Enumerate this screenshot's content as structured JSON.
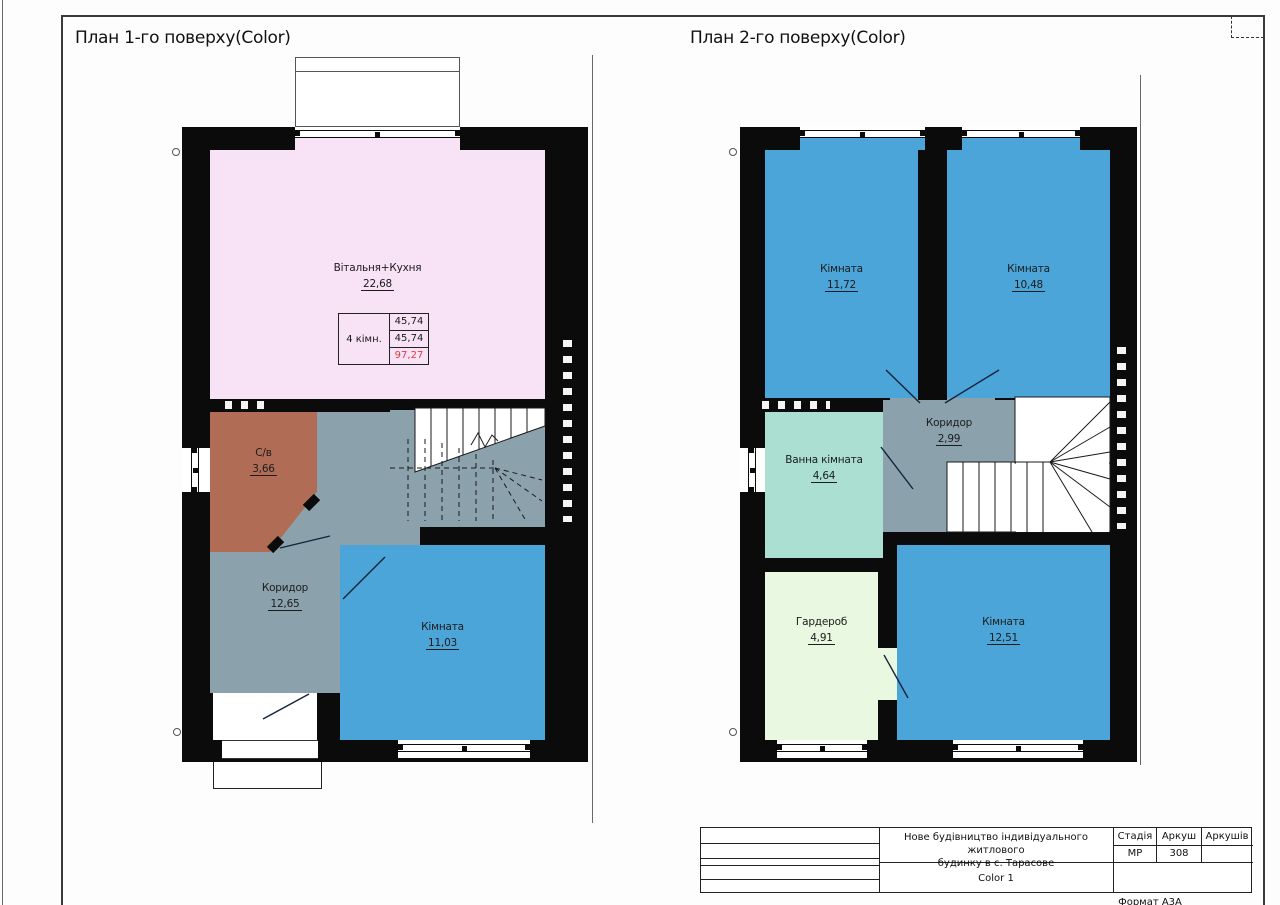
{
  "sheet": {
    "format_note": "Формат А3А"
  },
  "colors": {
    "wall": "#0b0b0b",
    "living_kitchen": "#f7e2f6",
    "room_blue": "#4ba5d8",
    "corridor_gray": "#8ba2ac",
    "wc_brown": "#b06c55",
    "bath_teal": "#aadfd2",
    "wardrobe_green": "#e9f8e1",
    "total_red": "#e03c3c"
  },
  "plan1": {
    "title": "План 1-го поверху(Color)",
    "rooms": [
      {
        "name": "Вітальня+Кухня",
        "area": "22,68"
      },
      {
        "name": "С/в",
        "area": "3,66"
      },
      {
        "name": "Коридор",
        "area": "12,65"
      },
      {
        "name": "Кімната",
        "area": "11,03"
      }
    ],
    "summary": {
      "label": "4 кімн.",
      "rows": [
        "45,74",
        "45,74",
        "97,27"
      ]
    }
  },
  "plan2": {
    "title": "План 2-го поверху(Color)",
    "rooms": [
      {
        "name": "Кімната",
        "area": "11,72"
      },
      {
        "name": "Кімната",
        "area": "10,48"
      },
      {
        "name": "Коридор",
        "area": "2,99"
      },
      {
        "name": "Ванна кімната",
        "area": "4,64"
      },
      {
        "name": "Гардероб",
        "area": "4,91"
      },
      {
        "name": "Кімната",
        "area": "12,51"
      }
    ]
  },
  "title_block": {
    "project_line1": "Нове будівництво індивідуального житлового",
    "project_line2": "будинку в с. Тарасове",
    "stage_label": "Стадія",
    "stage_value": "МР",
    "sheet_label": "Аркуш",
    "sheet_value": "308",
    "sheets_label": "Аркушів",
    "sheets_value": "",
    "doc_name": "Color 1"
  }
}
